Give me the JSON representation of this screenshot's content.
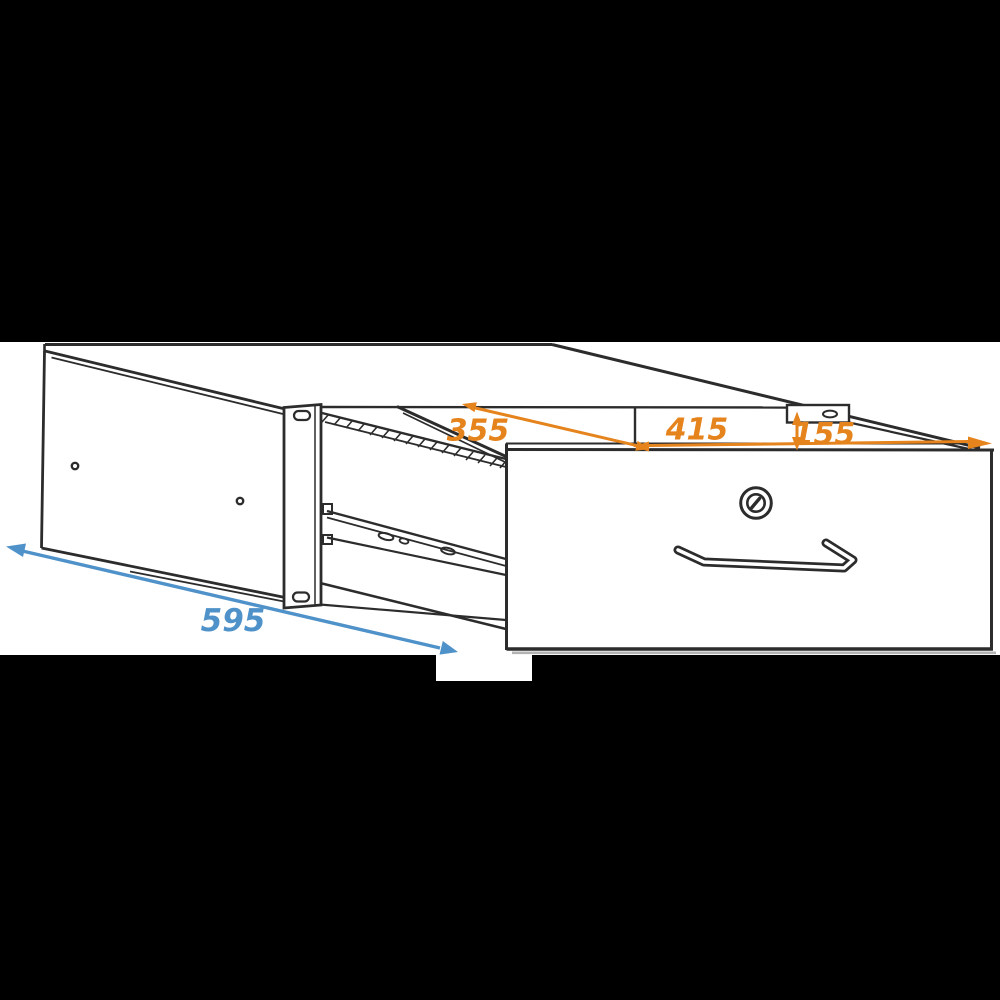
{
  "diagram": {
    "kind": "technical line drawing of a rack-mount drawer pulled open",
    "dimensions": [
      {
        "id": "dim-355",
        "label": "355",
        "placement": "diagonal arrow on open top, left",
        "color": "orange"
      },
      {
        "id": "dim-415",
        "label": "415",
        "placement": "horizontal arrow along drawer top edge",
        "color": "orange"
      },
      {
        "id": "dim-155",
        "label": "155",
        "placement": "vertical arrow at right rack ear",
        "color": "orange"
      },
      {
        "id": "dim-595",
        "label": "595",
        "placement": "diagonal arrow along case bottom front",
        "color": "blue"
      }
    ]
  },
  "colors": {
    "dimension_orange": "#e5831c",
    "dimension_blue": "#4f92c9",
    "line": "#2c2c2c",
    "shadow": "#b3b3b3",
    "letterbox": "#000000",
    "background": "#ffffff"
  }
}
